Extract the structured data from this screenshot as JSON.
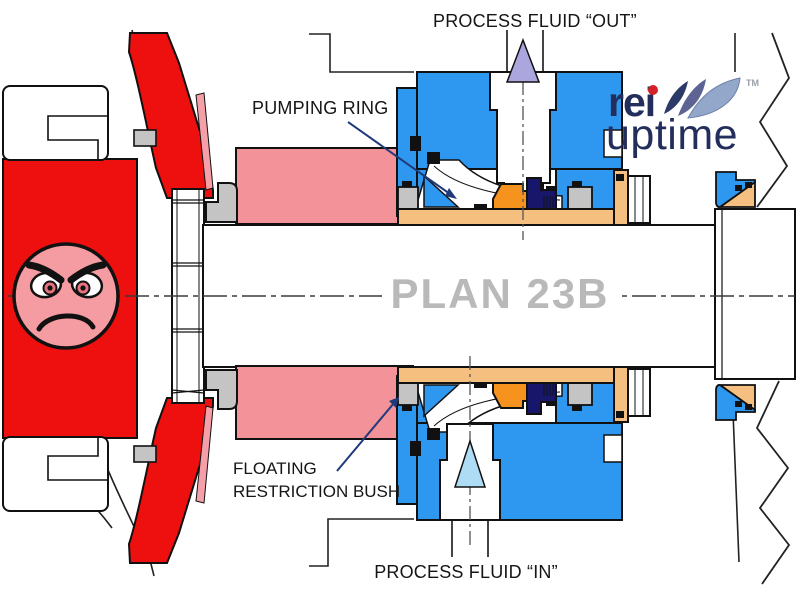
{
  "title": "Plan 23B mechanical seal cross-section diagram",
  "labels": {
    "process_fluid_out": "PROCESS FLUID “OUT”",
    "pumping_ring": "PUMPING RING",
    "floating_line1": "FLOATING",
    "floating_line2": "RESTRICTION BUSH",
    "process_fluid_in": "PROCESS FLUID “IN”",
    "plan": "PLAN 23B"
  },
  "logo": {
    "brand_top": "rei",
    "brand_bottom": "uptime",
    "trademark": "TM"
  },
  "colors": {
    "casing_red": "#EE0F0F",
    "face_pink": "#F59CA2",
    "chamber_pink": "#F4929A",
    "gland_blue": "#2E97F0",
    "arrow_out_lavender": "#ACA6DF",
    "arrow_in_lightblue": "#AEDCF5",
    "sleeve_tan": "#F5C07F",
    "seal_orange": "#F6921E",
    "seal_navy": "#17166B",
    "hardware_gray": "#C4C4C4",
    "plan_text_gray": "#B9B9B9",
    "leader_navy": "#1F3A7A",
    "logo_navy": "#232E5C",
    "logo_red": "#D42027"
  }
}
